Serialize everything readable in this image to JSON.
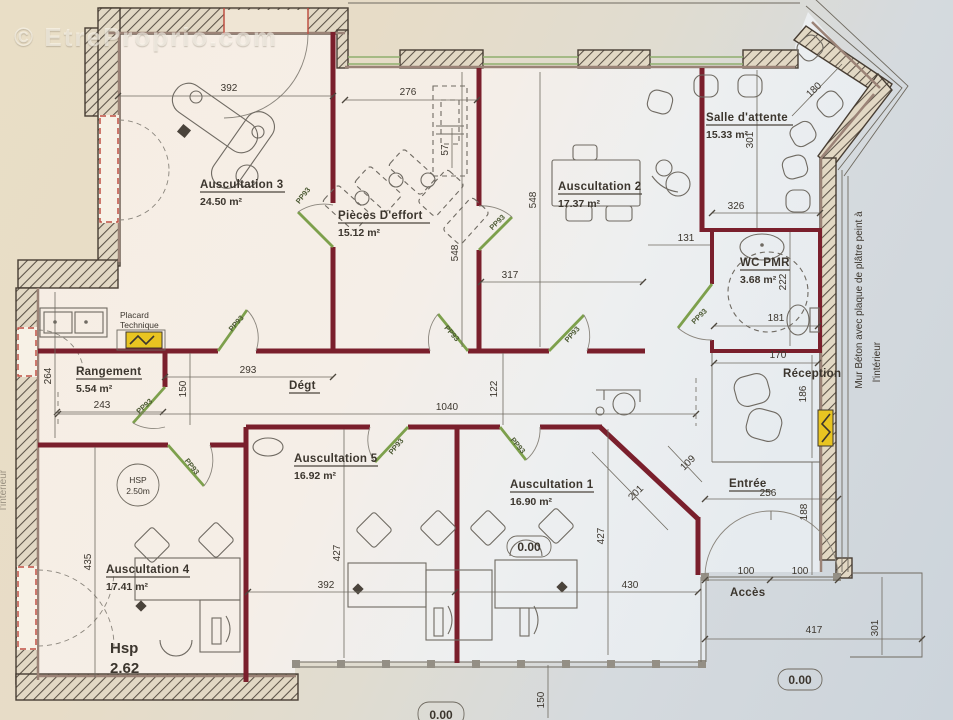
{
  "watermark": "© EtreProprio.com",
  "rooms": {
    "ausc3": {
      "name": "Auscultation 3",
      "area": "24.50 m²"
    },
    "pieces": {
      "name": "Pièces D'effort",
      "area": "15.12 m²"
    },
    "ausc2": {
      "name": "Auscultation 2",
      "area": "17.37 m²"
    },
    "salle": {
      "name": "Salle d'attente",
      "area": "15.33 m²"
    },
    "wc": {
      "name": "WC PMR",
      "area": "3.68 m²"
    },
    "rangement": {
      "name": "Rangement",
      "area": "5.54 m²"
    },
    "ausc5": {
      "name": "Auscultation 5",
      "area": "16.92 m²"
    },
    "ausc1": {
      "name": "Auscultation 1",
      "area": "16.90 m²"
    },
    "ausc4": {
      "name": "Auscultation 4",
      "area": "17.41 m²"
    },
    "reception": {
      "name": "Réception"
    },
    "degt": {
      "name": "Dégt"
    },
    "entree": {
      "name": "Entrée"
    },
    "acces": {
      "name": "Accès"
    }
  },
  "annotations": {
    "placard_line1": "Placard",
    "placard_line2": "Technique",
    "hsp_circle_line1": "HSP",
    "hsp_circle_line2": "2.50m",
    "hsp_line1": "Hsp",
    "hsp_line2": "2.62",
    "wall_note_line1": "Mur Béton avec plaque de plâtre peint à",
    "wall_note_line2": "l'intérieur",
    "left_note": "l'intérieur",
    "door_tag": "PP93",
    "level": "0.00"
  },
  "dims": {
    "ausc3_width": "392",
    "pieces_width": "276",
    "pieces_depth": "57",
    "pieces_height": "548",
    "ausc2_height": "548",
    "ausc2_width": "317",
    "salle_width": "326",
    "salle_height": "301",
    "salle_diag": "180",
    "wc_corridor": "131",
    "wc_height": "222",
    "wc_width": "181",
    "reception_width": "170",
    "reception_height": "186",
    "rangement_height": "264",
    "rangement_width": "243",
    "degt_width": "293",
    "degt_height_left": "150",
    "degt_length": "1040",
    "degt_height_right": "122",
    "ausc4_height": "435",
    "ausc5_height": "427",
    "ausc5_width": "392",
    "ausc1_height": "427",
    "ausc1_width": "430",
    "diag_wall": "201",
    "diag_cut": "109",
    "entree_width": "256",
    "entree_height": "188",
    "door_left": "100",
    "door_right": "100",
    "acces_width": "417",
    "exterior_side": "301",
    "facade_offset": "150"
  },
  "colors": {
    "partition_wall": "#7a1f2c",
    "door_green": "#7da04c",
    "window_red": "#bf5043",
    "electrical_yellow": "#e8c421",
    "paper_beige": "#e9dec6",
    "paper_blue": "#ccd4db"
  }
}
